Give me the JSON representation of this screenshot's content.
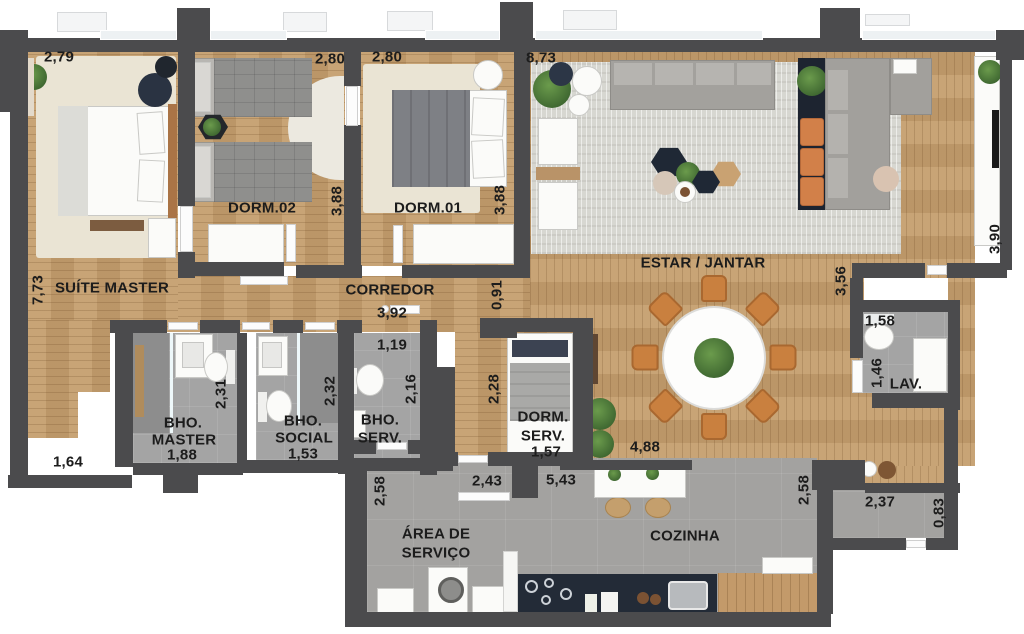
{
  "rooms": {
    "suite_master": {
      "name": "SUÍTE MASTER",
      "w": "2,79",
      "h": "7,73"
    },
    "dorm_02": {
      "name": "DORM.02",
      "w": "2,80",
      "h": "3,88"
    },
    "dorm_01": {
      "name": "DORM.01",
      "w": "2,80",
      "h": "3,88"
    },
    "estar_jantar": {
      "name": "ESTAR / JANTAR",
      "w": "8,73",
      "h_right": "3,90",
      "h_inner": "3,56"
    },
    "corredor": {
      "name": "CORREDOR",
      "l": "3,92",
      "w": "0,91"
    },
    "bho_master": {
      "name_line1": "BHO.",
      "name_line2": "MASTER",
      "w": "1,88",
      "h": "2,31"
    },
    "bho_social": {
      "name_line1": "BHO.",
      "name_line2": "SOCIAL",
      "w": "1,53",
      "h": "2,32"
    },
    "bho_serv": {
      "name_line1": "BHO.",
      "name_line2": "SERV.",
      "w": "1,19",
      "h": "2,16"
    },
    "dorm_serv": {
      "name_line1": "DORM.",
      "name_line2": "SERV.",
      "w": "1,57",
      "h": "2,28"
    },
    "lav": {
      "name": "LAV.",
      "w": "1,58",
      "h": "1,46"
    },
    "area_servico": {
      "name_line1": "ÁREA DE",
      "name_line2": "SERVIÇO",
      "w": "2,43",
      "h": "2,58"
    },
    "cozinha": {
      "name": "COZINHA",
      "w": "5,43",
      "h": "2,58"
    },
    "entry_hall": {
      "w": "1,64"
    },
    "kitchen_opening": {
      "w": "4,88"
    },
    "service_passage": {
      "w": "2,37",
      "h": "0,83"
    }
  },
  "colors": {
    "wall": "#4b4b4d",
    "wood_floor": "#c59e6d",
    "tile_floor": "#a4a4a4",
    "rug_gray": "#d7d7d1",
    "rug_cream": "#eae4d4",
    "accent_orange": "#cc7f45",
    "accent_navy": "#222a37",
    "plant_green": "#47703a",
    "window": "#edf1f3"
  }
}
